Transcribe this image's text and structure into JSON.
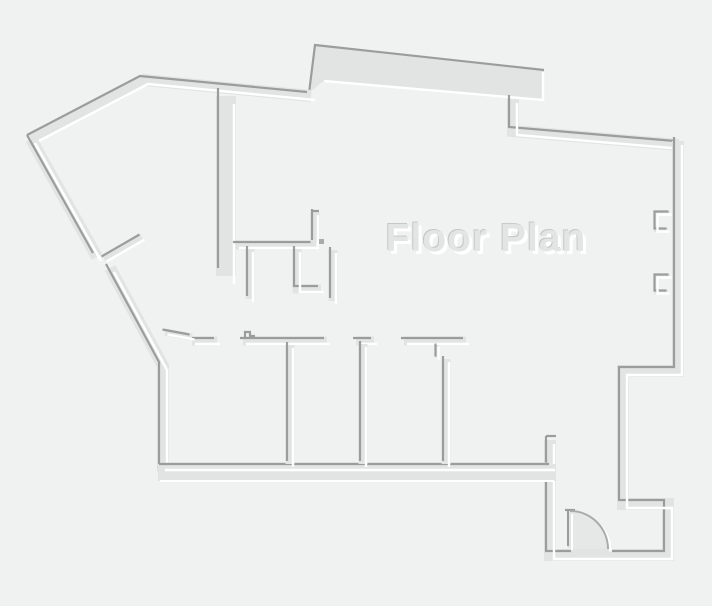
{
  "title": "Floor Plan",
  "colors": {
    "background": "#f0f1f1",
    "wall": "#e2e4e4",
    "edge_dark": "#9b9d9d",
    "edge_light": "#ffffff",
    "door_fill": "#e6e8e8",
    "door_arc": "#a9abab",
    "title_fill": "#e3e5e5",
    "title_dark": "#c6c8c8",
    "title_light": "#ffffff"
  },
  "canvas": {
    "width": 712,
    "height": 606
  },
  "floor_plan": {
    "slab": {
      "polygon": [
        [
          315,
          45
        ],
        [
          544,
          70
        ],
        [
          544,
          101
        ],
        [
          322,
          82
        ],
        [
          309,
          93
        ]
      ],
      "dark_edge": [
        [
          309,
          93
        ],
        [
          315,
          45
        ],
        [
          544,
          70
        ]
      ],
      "light_edge": [
        [
          543,
          72
        ],
        [
          543,
          100
        ],
        [
          324,
          81
        ]
      ]
    },
    "bottom_band": {
      "x": 158,
      "y": 464,
      "width": 398,
      "height": 17,
      "light_edge": [
        [
          160,
          481
        ],
        [
          554,
          481
        ]
      ]
    },
    "wall_groups": [
      {
        "name": "outer-walls",
        "width": 12,
        "offset": 4,
        "paths": [
          [
            [
              31,
              139
            ],
            [
              144,
              80
            ],
            [
              311,
              96
            ]
          ],
          [
            [
              31,
              139
            ],
            [
              97,
              257
            ]
          ],
          [
            [
              110,
              268
            ],
            [
              163,
              366
            ],
            [
              163,
              472
            ]
          ],
          [
            [
              513,
              99
            ],
            [
              513,
              131
            ],
            [
              679,
              145
            ]
          ],
          [
            [
              678,
              141
            ],
            [
              678,
              371
            ],
            [
              623,
              371
            ],
            [
              623,
              504
            ],
            [
              668,
              504
            ],
            [
              668,
              555
            ],
            [
              550,
              555
            ],
            [
              550,
              440
            ]
          ]
        ]
      },
      {
        "name": "room-bottom-wall",
        "width": 9,
        "offset": 3,
        "paths": [
          [
            [
              162,
              467
            ],
            [
              552,
              467
            ]
          ]
        ]
      },
      {
        "name": "corridor-wall",
        "width": 20,
        "offset": 8,
        "paths": [
          [
            [
              226,
              96
            ],
            [
              226,
              276
            ]
          ]
        ]
      },
      {
        "name": "inner-walls",
        "width": 9,
        "offset": 3,
        "paths": [
          [
            [
              236,
              245
            ],
            [
              316,
              245
            ]
          ],
          [
            [
              315,
              243
            ],
            [
              315,
              212
            ]
          ],
          [
            [
              250,
              249
            ],
            [
              250,
              299
            ]
          ],
          [
            [
              297,
              249
            ],
            [
              297,
              289
            ],
            [
              321,
              289
            ]
          ],
          [
            [
              333,
              250
            ],
            [
              333,
              301
            ]
          ],
          [
            [
              192,
              341
            ],
            [
              217,
              341
            ]
          ],
          [
            [
              243,
              341
            ],
            [
              327,
              341
            ]
          ],
          [
            [
              356,
              341
            ],
            [
              374,
              341
            ]
          ],
          [
            [
              404,
              341
            ],
            [
              466,
              341
            ]
          ],
          [
            [
              290,
              345
            ],
            [
              290,
              464
            ]
          ],
          [
            [
              363,
              344
            ],
            [
              363,
              464
            ]
          ],
          [
            [
              446,
              359
            ],
            [
              446,
              464
            ]
          ]
        ]
      },
      {
        "name": "window-marks",
        "width": 4,
        "offset": 1.5,
        "paths": [
          [
            [
              670,
              213
            ],
            [
              656,
              213
            ],
            [
              656,
              230
            ],
            [
              668,
              230
            ]
          ],
          [
            [
              670,
              276
            ],
            [
              656,
              276
            ],
            [
              656,
              292
            ],
            [
              668,
              292
            ]
          ],
          [
            [
              437,
              345
            ],
            [
              437,
              358
            ]
          ]
        ]
      },
      {
        "name": "door-leaves",
        "width": 7,
        "offset": 2.5,
        "paths": [
          [
            [
              104,
              259
            ],
            [
              142,
              237
            ]
          ],
          [
            [
              165,
              332
            ],
            [
              192,
              337
            ]
          ]
        ]
      }
    ],
    "ticks": [
      [
        [
          546,
          436
        ],
        [
          556,
          436
        ]
      ],
      [
        [
          311,
          211
        ],
        [
          319,
          211
        ]
      ],
      [
        [
          245,
          337
        ],
        [
          245,
          332
        ],
        [
          250,
          332
        ],
        [
          250,
          336
        ],
        [
          255,
          336
        ]
      ],
      [
        [
          565,
          510
        ],
        [
          575,
          510
        ]
      ]
    ],
    "dot": {
      "x": 319,
      "y": 239,
      "width": 5,
      "height": 5
    },
    "entry_door": {
      "patch": {
        "x": 571,
        "y": 545,
        "width": 41,
        "height": 9
      },
      "hinge": [
        570,
        549
      ],
      "radius": 38,
      "leaf": [
        [
          570,
          512
        ],
        [
          570,
          548
        ]
      ],
      "leaf_width": 5,
      "leaf_offset": 2
    }
  }
}
